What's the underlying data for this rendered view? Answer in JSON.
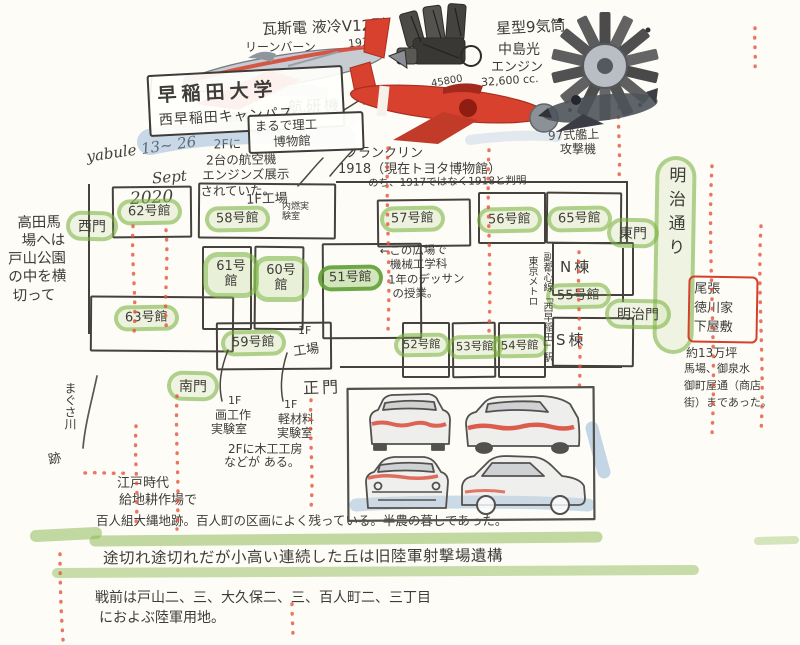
{
  "banner": {
    "university": "早稲田大学",
    "campus": "西早稲田キャンパス",
    "note_line1": "まるで理工",
    "note_line2": "博物館"
  },
  "signature": {
    "name": "yabule 13~ 26",
    "month": "Sept",
    "year": "2020"
  },
  "engine_v12": {
    "title": "瓦斯電 液冷V12型",
    "sub1": "リーンバーン",
    "year": "1938",
    "sub2": "（希薄燃焼）の",
    "sub3": "ベース",
    "cc": "45800",
    "cc_unit": "cc."
  },
  "kenkyuki": {
    "name": "航研機",
    "note1": "日野オートプラザに",
    "note2": "現在展示。"
  },
  "exhibit_note": {
    "l1": "2Fに",
    "l2": "2台の航空機",
    "l3": "エンジンズ展示",
    "l4": "されていた。"
  },
  "franklin": {
    "l1": "フランクリン",
    "l2": "1918（現在トヨタ博物館）",
    "l3": "のち、1917ではなく1918と判明"
  },
  "radial_engine": {
    "l1": "星型9気筒",
    "l2": "中島光",
    "l3": "エンジン",
    "cc": "32,600 cc."
  },
  "type97": {
    "l1": "97式艦上",
    "l2": "攻撃機"
  },
  "meiji_street": "明治通り",
  "plaza_note": {
    "l1": "←この広場で",
    "l2": "機械工学科",
    "l3": "1年のデッサン",
    "l4": "の授業。"
  },
  "left_note": {
    "l1": "高田馬",
    "l2": "場へは",
    "l3": "戸山公園",
    "l4": "の中を横",
    "l5": "切って"
  },
  "magusa": {
    "l1": "まぐさ川",
    "l2": "跡"
  },
  "subway": {
    "left_col": "東京メトロ",
    "right_col": "副都心線「西早稲田」駅"
  },
  "map": {
    "buildings": [
      {
        "label": "62号館"
      },
      {
        "label": "58号館"
      },
      {
        "label": "57号館"
      },
      {
        "label": "56号館"
      },
      {
        "label": "65号館"
      },
      {
        "label": "61号館"
      },
      {
        "label": "60号館"
      },
      {
        "label": "51号館"
      },
      {
        "label": "55号館"
      },
      {
        "label": "63号館"
      },
      {
        "label": "59号館"
      },
      {
        "label": "52号館"
      },
      {
        "label": "53号館"
      },
      {
        "label": "54号館"
      }
    ],
    "gates": [
      {
        "label": "西門"
      },
      {
        "label": "東門"
      },
      {
        "label": "南門"
      },
      {
        "label": "明治門"
      },
      {
        "label": "正門"
      }
    ],
    "wings": [
      {
        "label": "N棟"
      },
      {
        "label": "S棟"
      }
    ],
    "factory_top": {
      "l1": "1F工場",
      "l2": "内燃実験室"
    },
    "factory_59": {
      "l1": "1F",
      "l2": "工場"
    }
  },
  "workshops": {
    "w1_floor": "1F",
    "w1_name": "画工作",
    "w1_name2": "実験室",
    "w2_floor": "1F",
    "w2_name": "軽材料",
    "w2_name2": "実験室",
    "w3_l1": "2Fに木工工房",
    "w3_l2": "などが ある。"
  },
  "owari": {
    "box_l1": "尾張",
    "box_l2": "徳川家",
    "box_l3": "下屋敷",
    "note1": "約13万坪",
    "note2": "馬場、御泉水",
    "note3": "御町屋通（商店",
    "note4": "街）まであった。"
  },
  "history": {
    "edo_l1": "江戸時代",
    "edo_l2": "給地耕作場で",
    "hyakunin": "百人組大縄地跡。百人町の区画によく残っている。半農の暮しであった。",
    "highlight": "途切れ途切れだが小高い連続した丘は旧陸軍射撃場遺構",
    "prewar_l1": "戦前は戸山二、三、大久保二、三、百人町二、三丁目",
    "prewar_l2": "におよぶ陸軍用地。"
  },
  "colors": {
    "marker_green": "#7cb342",
    "ink": "#3f3c38",
    "red_ink": "#e4543c",
    "red_paint": "#d8412e",
    "blue_wash": "#7fa8d0"
  }
}
